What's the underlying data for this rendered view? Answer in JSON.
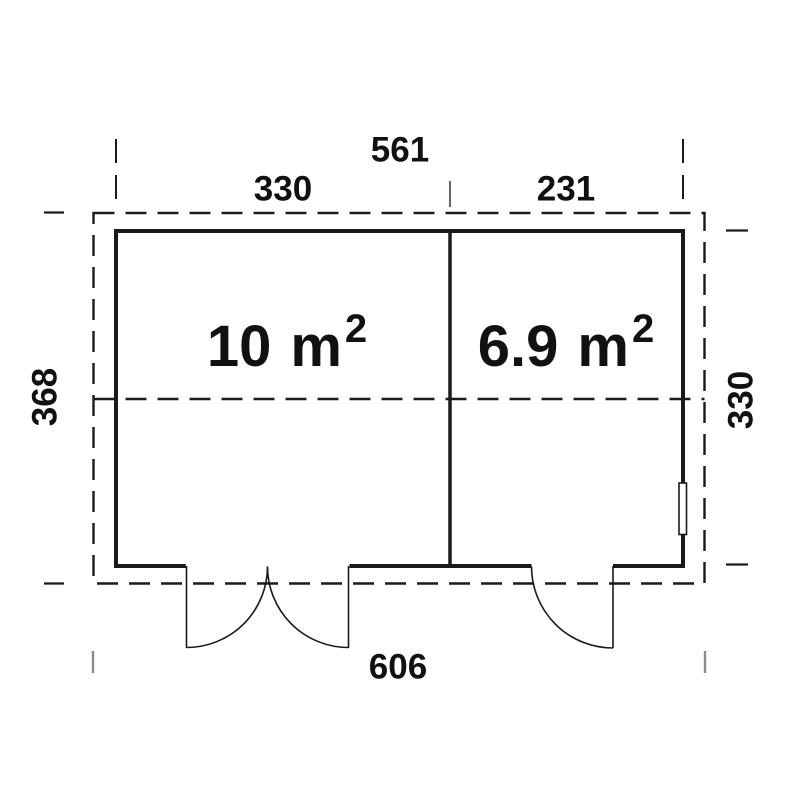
{
  "dims": {
    "top_overall": "561",
    "top_left_section": "330",
    "top_right_section": "231",
    "left_depth": "368",
    "right_interior_depth": "330",
    "bottom_overall": "606"
  },
  "rooms": [
    {
      "name": "room-1",
      "area": "10",
      "unit": "m",
      "sup": "2"
    },
    {
      "name": "room-2",
      "area": "6.9",
      "unit": "m",
      "sup": "2"
    }
  ],
  "colors": {
    "line": "#1a1a1a",
    "tick_gray": "#8a8a8a",
    "divider_tick": "#555555",
    "background": "#ffffff",
    "text": "#111111"
  }
}
